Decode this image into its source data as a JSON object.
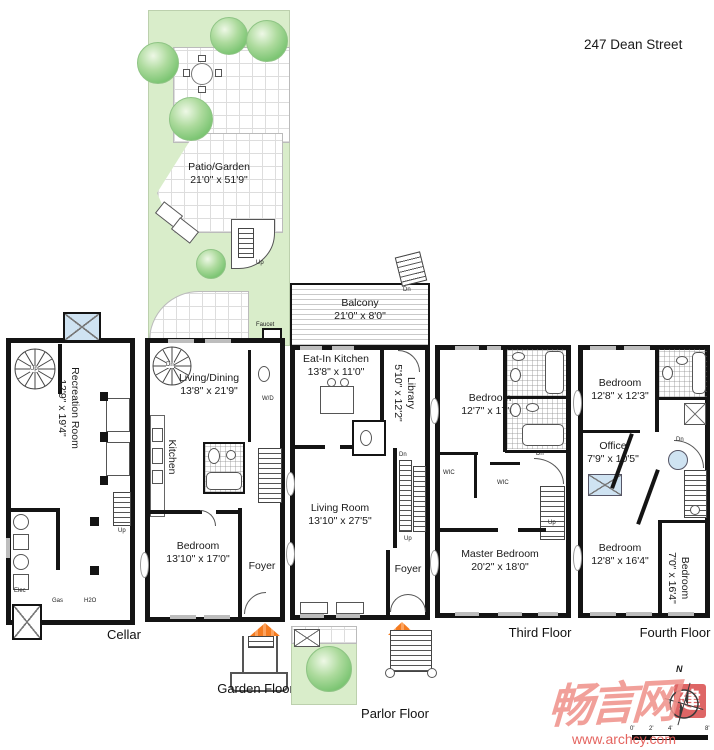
{
  "title": "247 Dean Street",
  "outdoor": {
    "patio": {
      "name": "Patio/Garden",
      "dims": "21'0\" x 51'9\""
    },
    "balcony": {
      "name": "Balcony",
      "dims": "21'0\" x 8'0\""
    },
    "faucet_label": "Faucet"
  },
  "floors": {
    "cellar": {
      "label": "Cellar",
      "recreation": {
        "name": "Recreation Room",
        "dims": "12'9\" x 19'4\""
      },
      "utilities": {
        "elec": "Elec",
        "gas": "Gas",
        "h2o": "H2O"
      }
    },
    "garden": {
      "label": "Garden Floor",
      "living_dining": {
        "name": "Living/Dining",
        "dims": "13'8\" x 21'9\""
      },
      "kitchen": {
        "name": "Kitchen"
      },
      "bedroom": {
        "name": "Bedroom",
        "dims": "13'10\" x 17'0\""
      },
      "foyer": {
        "name": "Foyer"
      },
      "wd": "W/D"
    },
    "parlor": {
      "label": "Parlor Floor",
      "eat_in_kitchen": {
        "name": "Eat-In Kitchen",
        "dims": "13'8\" x 11'0\""
      },
      "library": {
        "name": "Library",
        "dims": "5'10\" x 12'2\""
      },
      "living_room": {
        "name": "Living Room",
        "dims": "13'10\" x 27'5\""
      },
      "foyer": {
        "name": "Foyer"
      }
    },
    "third": {
      "label": "Third Floor",
      "bedroom": {
        "name": "Bedroom",
        "dims": "12'7\" x 17'0\""
      },
      "master_bedroom": {
        "name": "Master Bedroom",
        "dims": "20'2\" x 18'0\""
      },
      "wic": "WIC"
    },
    "fourth": {
      "label": "Fourth Floor",
      "bedroom_top": {
        "name": "Bedroom",
        "dims": "12'8\" x 12'3\""
      },
      "office": {
        "name": "Office",
        "dims": "7'9\" x 10'5\""
      },
      "bedroom_bottom": {
        "name": "Bedroom",
        "dims": "12'8\" x 16'4\""
      },
      "bedroom_side": {
        "name": "Bedroom",
        "dims": "7'0\" x 16'4\""
      }
    }
  },
  "annotations": {
    "up": "Up",
    "dn": "Dn"
  },
  "watermark": {
    "brand": "畅言网",
    "url": "www.archcy.com",
    "seal": "建"
  },
  "compass": {
    "north": "N"
  },
  "scale_bar": {
    "ticks": [
      "0'",
      "2'",
      "4'",
      "8'"
    ]
  },
  "colors": {
    "wall": "#141414",
    "garden_green": "#d9edca",
    "awning_orange": "#f47b20",
    "skylight_blue": "#cfe3f2",
    "watermark_pink": "#f0948d",
    "watermark_red": "#e25752"
  }
}
